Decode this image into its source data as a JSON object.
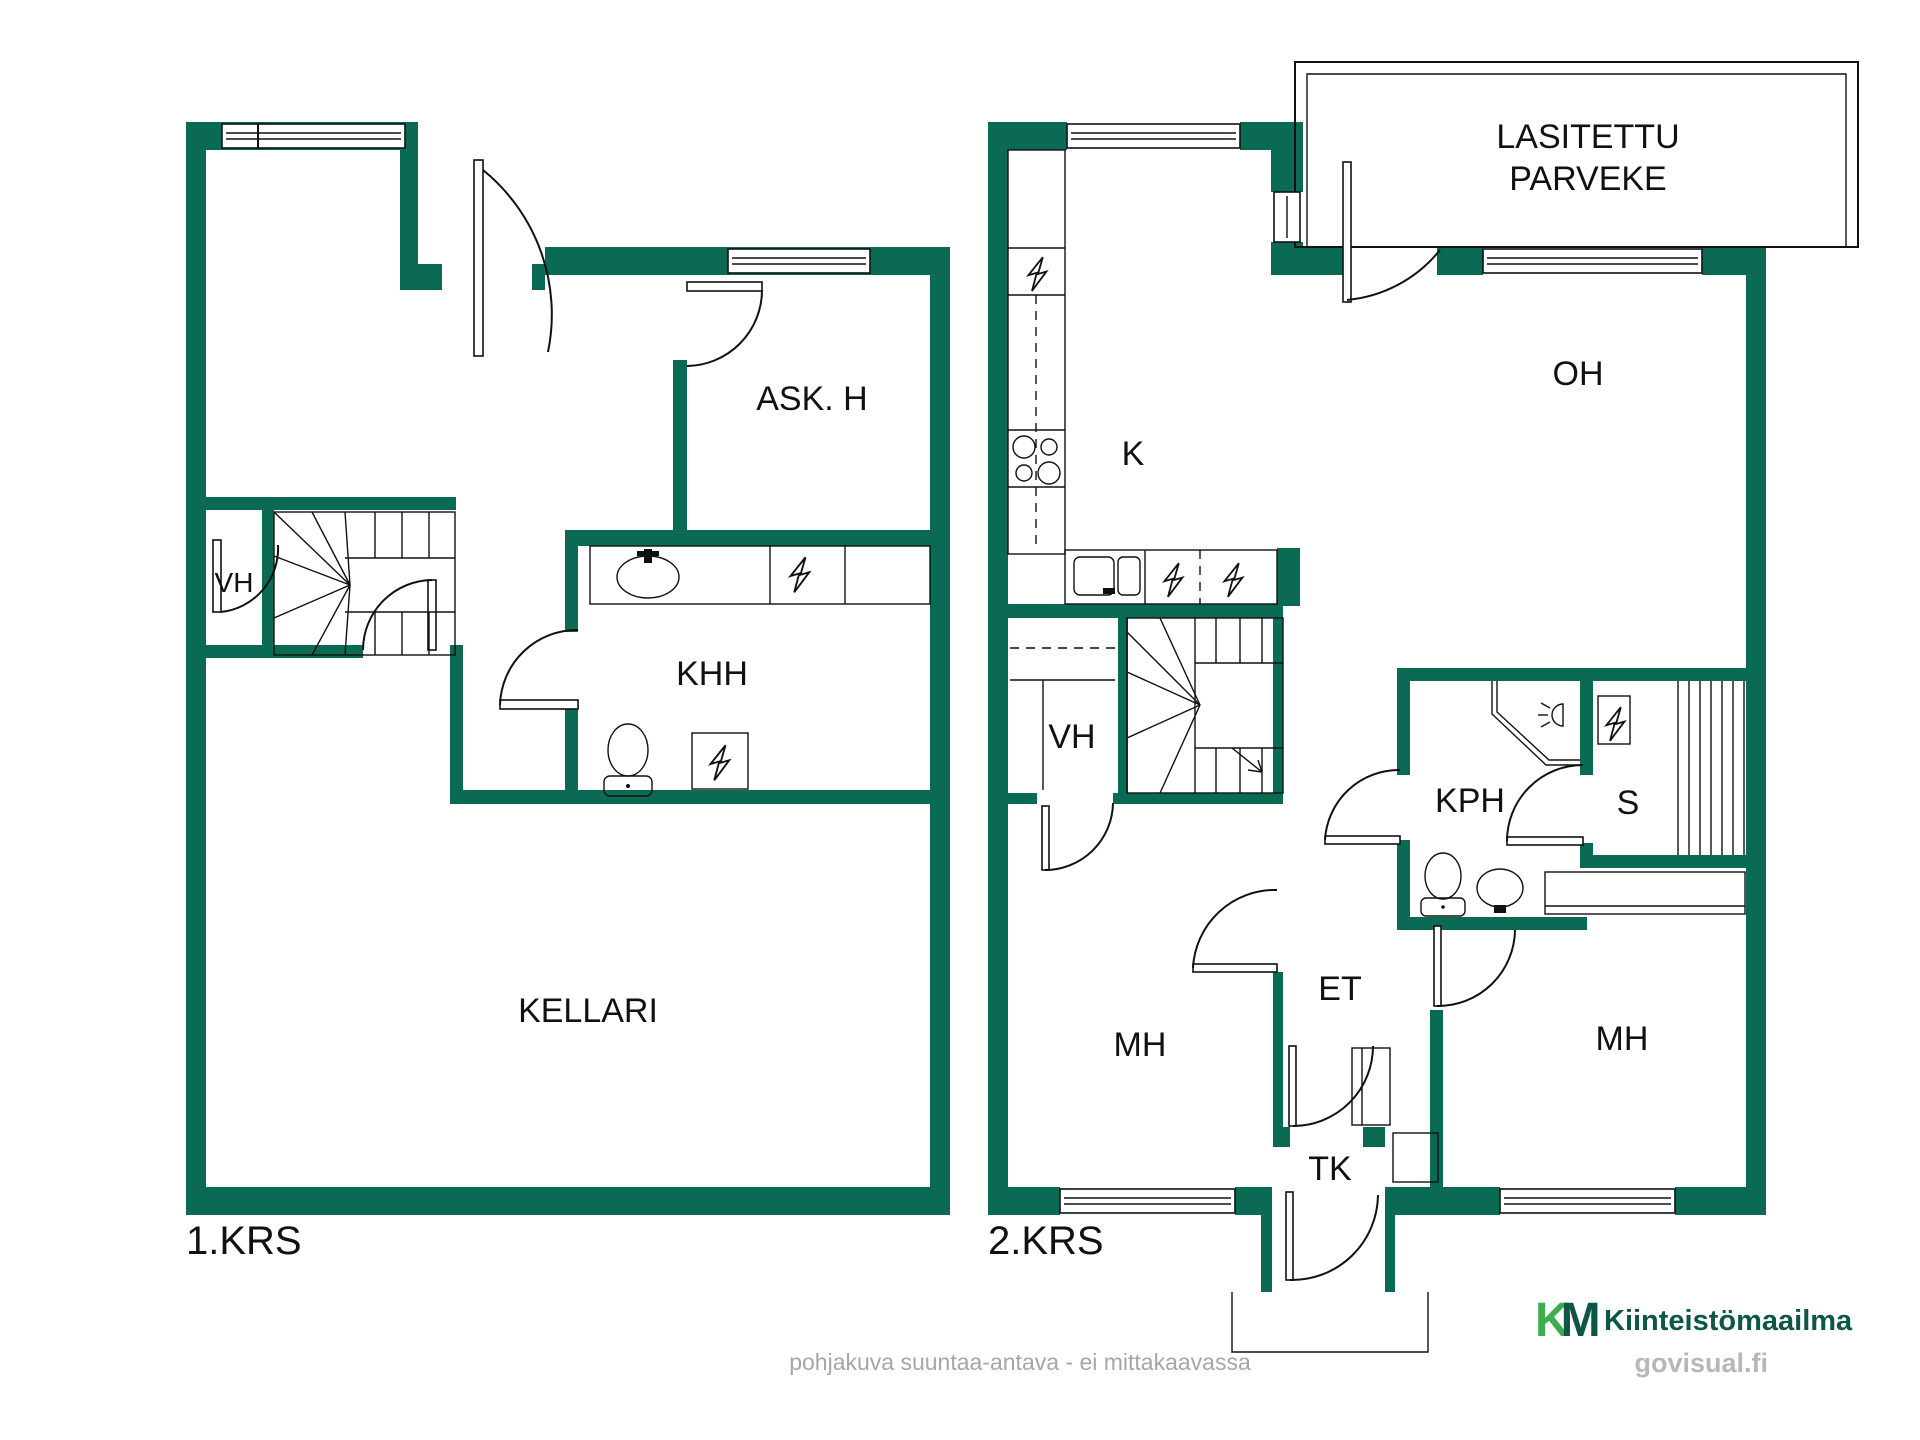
{
  "floor1": {
    "label": "1.KRS",
    "rooms": {
      "ask_h": "ASK. H",
      "vh": "VH",
      "khh": "KHH",
      "kellari": "KELLARI"
    }
  },
  "floor2": {
    "label": "2.KRS",
    "balcony_line1": "LASITETTU",
    "balcony_line2": "PARVEKE",
    "rooms": {
      "k": "K",
      "oh": "OH",
      "vh": "VH",
      "kph": "KPH",
      "s": "S",
      "et": "ET",
      "mh_left": "MH",
      "mh_right": "MH",
      "tk": "TK"
    }
  },
  "footer": {
    "disclaimer": "pohjakuva suuntaa-antava - ei mittakaavassa"
  },
  "branding": {
    "logo_k": "K",
    "logo_m": "M",
    "company": "Kiinteistömaailma",
    "watermark": "govisual.fi"
  },
  "colors": {
    "wall_green": "#0b6a53",
    "line_black": "#111111",
    "logo_light_green": "#3cae4e",
    "logo_dark_green": "#0e5747",
    "disclaimer_gray": "#a6a6a6",
    "watermark_gray": "#b4b8ba"
  }
}
